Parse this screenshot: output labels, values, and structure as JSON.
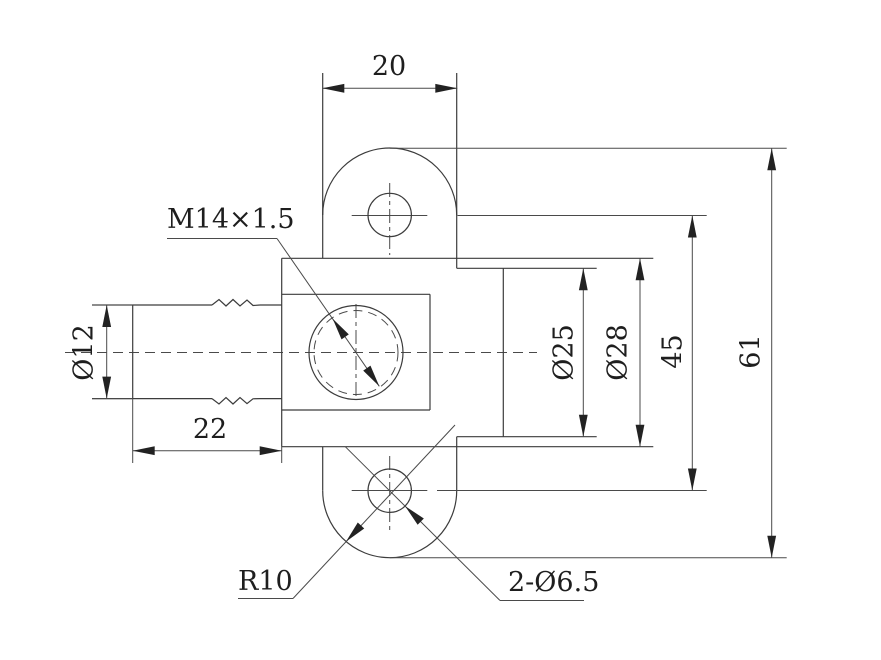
{
  "drawing": {
    "type": "engineering-part-drawing",
    "background": "#ffffff",
    "ink_color": "#3c3c3c",
    "text_color": "#1e1e1e",
    "labels": {
      "top_width": "20",
      "barb_diameter": "Ø12",
      "barb_length": "22",
      "thread_callout": "M14×1.5",
      "bore_diameter": "Ø25",
      "body_diameter": "Ø28",
      "hole_center_span": "45",
      "overall_height": "61",
      "ear_radius": "R10",
      "ear_holes": "2-Ø6.5"
    }
  }
}
